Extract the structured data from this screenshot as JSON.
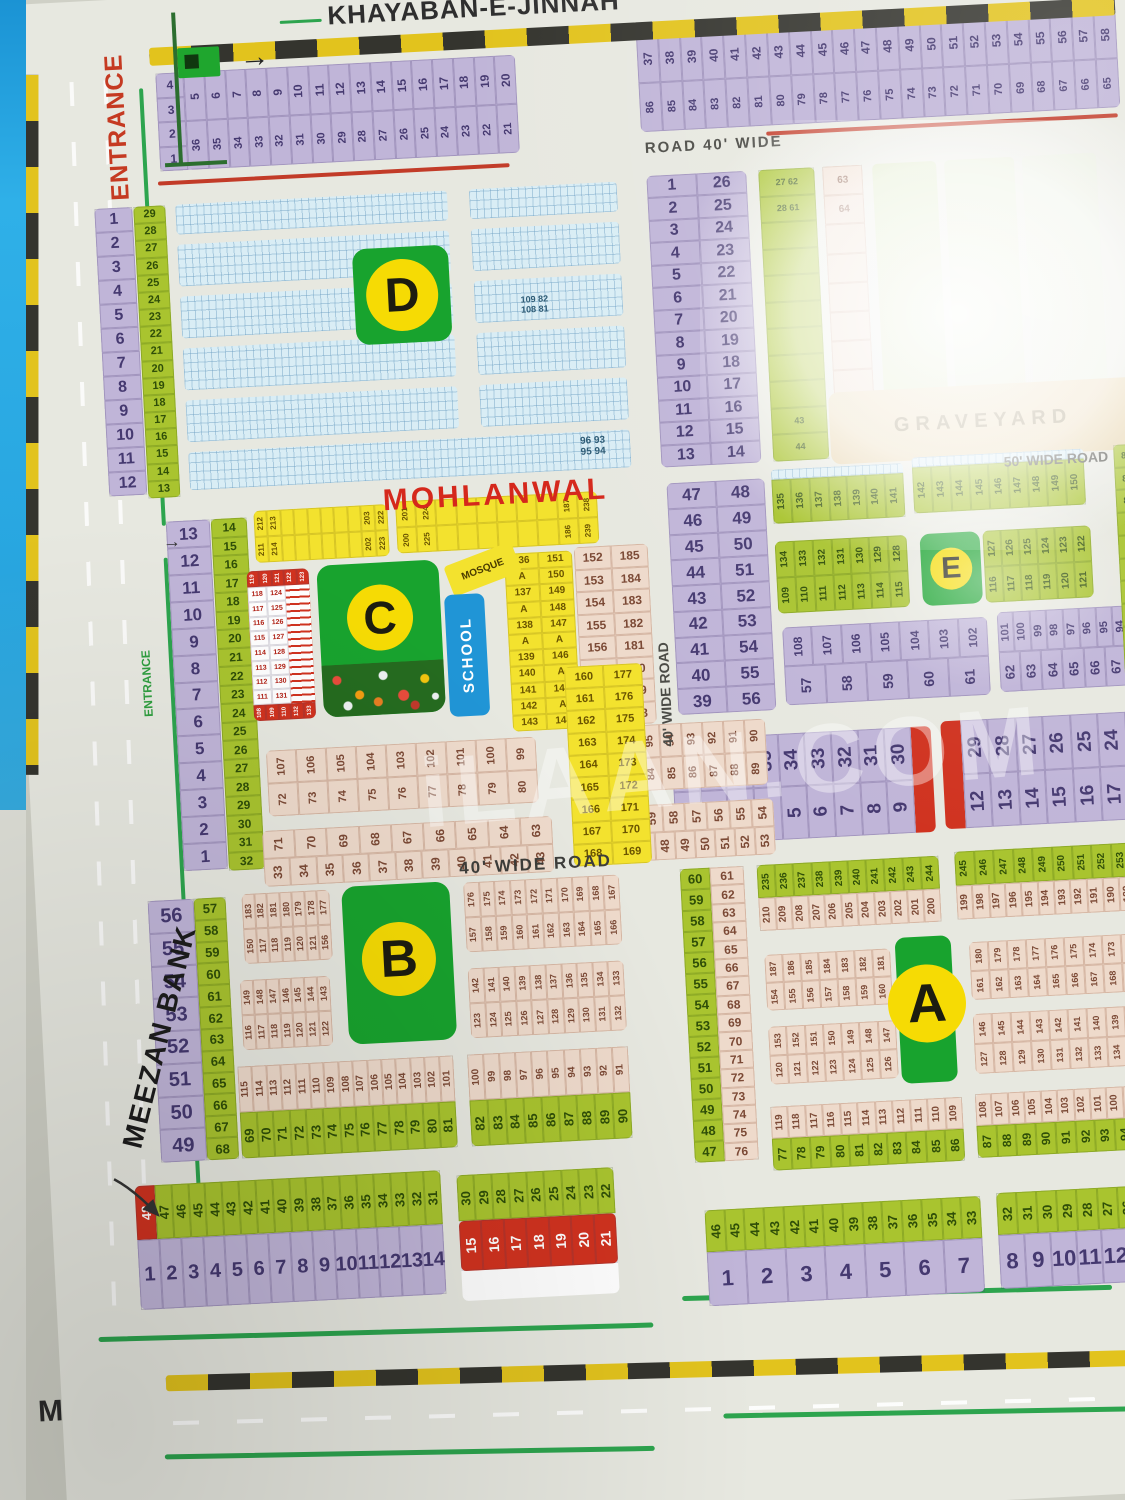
{
  "labels": {
    "road_top": "KHAYABAN-E-JINNAH",
    "entrance_main": "ENTRANCE",
    "entrance_small": "ENTRANCE",
    "road_corner": "ROAD",
    "road_40_wide": "ROAD 40' WIDE",
    "wide_50": "50' WIDE ROAD",
    "wide_40_v": "40' WIDE ROAD",
    "wide_40_h": "40' WIDE ROAD",
    "town": "MOHLANWAL",
    "bank": "MEEZAN BANK",
    "graveyard": "GRAVEYARD",
    "mosque": "MOSQUE",
    "school": "SCHOOL",
    "m": "M",
    "arrow": "→",
    "watermark": "iLAAN.COM"
  },
  "badges": {
    "a": "A",
    "b": "B",
    "c": "C",
    "d": "D",
    "e": "E"
  },
  "top_left_strip": {
    "left_col": [
      "4",
      "3",
      "2",
      "1"
    ],
    "row_top": [
      "5",
      "6",
      "7",
      "8",
      "9",
      "10",
      "11",
      "12",
      "13",
      "14",
      "15",
      "16",
      "17",
      "18",
      "19",
      "20"
    ],
    "row_bottom": [
      "36",
      "35",
      "34",
      "33",
      "32",
      "31",
      "30",
      "29",
      "28",
      "27",
      "26",
      "25",
      "24",
      "23",
      "22",
      "21"
    ]
  },
  "top_right_strip": {
    "row_top": [
      "37",
      "38",
      "39",
      "40",
      "41",
      "42",
      "43",
      "44",
      "45",
      "46",
      "47",
      "48",
      "49",
      "50",
      "51",
      "52",
      "53",
      "54",
      "55",
      "56",
      "57",
      "58"
    ],
    "row_bottom": [
      "86",
      "85",
      "84",
      "83",
      "82",
      "81",
      "80",
      "79",
      "78",
      "77",
      "76",
      "75",
      "74",
      "73",
      "72",
      "71",
      "70",
      "69",
      "68",
      "67",
      "66",
      "65"
    ]
  },
  "d_section": {
    "purple_col": [
      "1",
      "2",
      "3",
      "4",
      "5",
      "6",
      "7",
      "8",
      "9",
      "10",
      "11",
      "12"
    ],
    "green_col": [
      "29",
      "28",
      "27",
      "26",
      "25",
      "24",
      "23",
      "22",
      "21",
      "20",
      "19",
      "18",
      "17",
      "16",
      "15",
      "14",
      "13"
    ],
    "table": [
      [
        "1",
        "26"
      ],
      [
        "2",
        "25"
      ],
      [
        "3",
        "24"
      ],
      [
        "4",
        "23"
      ],
      [
        "5",
        "22"
      ],
      [
        "6",
        "21"
      ],
      [
        "7",
        "20"
      ],
      [
        "8",
        "19"
      ],
      [
        "9",
        "18"
      ],
      [
        "10",
        "17"
      ],
      [
        "11",
        "16"
      ],
      [
        "12",
        "15"
      ],
      [
        "13",
        "14"
      ]
    ],
    "green_strip": [
      "27 62",
      "28 61",
      "",
      "",
      "",
      "",
      "",
      "",
      "",
      "43",
      "44"
    ],
    "pink_strip": [
      "63",
      "64",
      "",
      "",
      "",
      "",
      "",
      "",
      "",
      ""
    ],
    "ann_mid_top": "109 82",
    "ann_mid_bottom": "108 81",
    "ann_br_top": "96 93",
    "ann_br_bottom": "95 94"
  },
  "c_section": {
    "purple_col": [
      "13",
      "12",
      "11",
      "10",
      "9",
      "8",
      "7",
      "6",
      "5",
      "4",
      "3",
      "2",
      "1"
    ],
    "green_col": [
      "14",
      "15",
      "16",
      "17",
      "18",
      "19",
      "20",
      "21",
      "22",
      "23",
      "24",
      "25",
      "26",
      "27",
      "28",
      "29",
      "30",
      "31",
      "32"
    ],
    "yellow1_top": [
      "212",
      "213",
      "",
      "",
      "",
      "",
      "",
      "",
      "203",
      "222"
    ],
    "yellow1_bottom": [
      "211",
      "214",
      "",
      "",
      "",
      "",
      "",
      "",
      "202",
      "223"
    ],
    "yellow2_top": [
      "201",
      "224",
      "",
      "",
      "",
      "",
      "",
      "",
      "187",
      "238"
    ],
    "yellow2_bottom": [
      "200",
      "225",
      "",
      "",
      "",
      "",
      "",
      "",
      "186",
      "239"
    ],
    "red_block": {
      "top": [
        "119",
        "120",
        "121",
        "122",
        "123"
      ],
      "pairs": [
        [
          "118",
          "124"
        ],
        [
          "117",
          "125"
        ],
        [
          "116",
          "126"
        ],
        [
          "115",
          "127"
        ],
        [
          "114",
          "128"
        ],
        [
          "113",
          "129"
        ],
        [
          "112",
          "130"
        ],
        [
          "111",
          "131"
        ]
      ],
      "bottom": [
        "108",
        "109",
        "110",
        "132",
        "133"
      ]
    },
    "yellow_pairs": [
      [
        "136",
        "151"
      ],
      [
        "A",
        "150"
      ],
      [
        "137",
        "149"
      ],
      [
        "A",
        "148"
      ],
      [
        "138",
        "147"
      ],
      [
        "A",
        "A"
      ],
      [
        "139",
        "146"
      ],
      [
        "140",
        "A"
      ],
      [
        "141",
        "145"
      ],
      [
        "142",
        "A"
      ],
      [
        "143",
        "144"
      ]
    ],
    "pink_pairs": [
      [
        "152",
        "185"
      ],
      [
        "153",
        "184"
      ],
      [
        "154",
        "183"
      ],
      [
        "155",
        "182"
      ],
      [
        "156",
        "181"
      ],
      [
        "157",
        "180"
      ],
      [
        "158",
        "179"
      ],
      [
        "159",
        "178"
      ]
    ]
  },
  "c_lower": {
    "left_r1": [
      "107",
      "106",
      "105",
      "104",
      "103",
      "102",
      "101",
      "100",
      "99"
    ],
    "left_r2": [
      "72",
      "73",
      "74",
      "75",
      "76",
      "77",
      "78",
      "79",
      "80"
    ],
    "left_r3": [
      "71",
      "70",
      "69",
      "68",
      "67",
      "66",
      "65",
      "64",
      "63"
    ],
    "left_r4": [
      "33",
      "34",
      "35",
      "36",
      "37",
      "38",
      "39",
      "40",
      "41",
      "42",
      "43"
    ],
    "right_r1": [
      "98",
      "97",
      "96",
      "95",
      "94",
      "93",
      "92",
      "91",
      "90"
    ],
    "right_r2": [
      "81",
      "82",
      "83",
      "84",
      "85",
      "86",
      "87",
      "88",
      "89"
    ],
    "right_r3": [
      "62",
      "61",
      "60",
      "59",
      "58",
      "57",
      "56",
      "55",
      "54"
    ],
    "right_r4": [
      "44",
      "45",
      "46",
      "47",
      "48",
      "49",
      "50",
      "51",
      "52",
      "53"
    ],
    "yellow_pairs": [
      [
        "160",
        "177"
      ],
      [
        "161",
        "176"
      ],
      [
        "162",
        "175"
      ],
      [
        "163",
        "174"
      ],
      [
        "164",
        "173"
      ],
      [
        "165",
        "172"
      ],
      [
        "166",
        "171"
      ],
      [
        "167",
        "170"
      ],
      [
        "168",
        "169"
      ]
    ]
  },
  "e_section": {
    "table": [
      [
        "47",
        "48"
      ],
      [
        "46",
        "49"
      ],
      [
        "45",
        "50"
      ],
      [
        "44",
        "51"
      ],
      [
        "43",
        "52"
      ],
      [
        "42",
        "53"
      ],
      [
        "41",
        "54"
      ],
      [
        "40",
        "55"
      ],
      [
        "39",
        "56"
      ]
    ],
    "strip1": [
      "135",
      "136",
      "137",
      "138",
      "139",
      "140",
      "141"
    ],
    "strip2": [
      "142",
      "143",
      "144",
      "145",
      "146",
      "147",
      "148",
      "149",
      "150"
    ],
    "block_left_top": [
      "134",
      "133",
      "132",
      "131",
      "130",
      "129",
      "128"
    ],
    "block_left_bottom": [
      "109",
      "110",
      "111",
      "112",
      "113",
      "114",
      "115"
    ],
    "block_right_top": [
      "127",
      "126",
      "125",
      "124",
      "123",
      "122"
    ],
    "block_right_bottom": [
      "116",
      "117",
      "118",
      "119",
      "120",
      "121"
    ],
    "purple_left_top": [
      "108",
      "107",
      "106",
      "105",
      "104",
      "103",
      "102"
    ],
    "purple_left_bottom": [
      "57",
      "58",
      "59",
      "60",
      "61"
    ],
    "purple_right_top": [
      "101",
      "100",
      "99",
      "98",
      "97",
      "96",
      "95",
      "94",
      "93"
    ],
    "purple_right_bottom": [
      "62",
      "63",
      "64",
      "65",
      "66",
      "67",
      "68"
    ],
    "right_col": [
      "82",
      "83",
      "84",
      "85",
      "86",
      "87",
      "88",
      "89",
      "90",
      "91",
      "92"
    ]
  },
  "mid_strips": {
    "s1_top": [
      "38",
      "37",
      "36",
      "35",
      "34",
      "33",
      "32",
      "31",
      "30"
    ],
    "s1_bottom": [
      "1",
      "2",
      "3",
      "4",
      "5",
      "6",
      "7",
      "8",
      "9"
    ],
    "s2_top": [
      "29",
      "28",
      "27",
      "26",
      "25",
      "24",
      "23"
    ],
    "s2_bottom": [
      "12",
      "13",
      "14",
      "15",
      "16",
      "17",
      "18"
    ]
  },
  "b_section": {
    "purple_col": [
      "56",
      "55",
      "54",
      "53",
      "52",
      "51",
      "50",
      "49"
    ],
    "green_col": [
      "57",
      "58",
      "59",
      "60",
      "61",
      "62",
      "63",
      "64",
      "65",
      "66",
      "67",
      "68"
    ],
    "tl_top": [
      "183",
      "182",
      "181",
      "180",
      "179",
      "178",
      "177"
    ],
    "tl_bottom": [
      "150",
      "117",
      "118",
      "119",
      "120",
      "121",
      "156"
    ],
    "ml_top": [
      "149",
      "148",
      "147",
      "146",
      "145",
      "144",
      "143"
    ],
    "ml_bottom": [
      "116",
      "117",
      "118",
      "119",
      "120",
      "121",
      "122"
    ],
    "tr_top": [
      "176",
      "175",
      "174",
      "173",
      "172",
      "171",
      "170",
      "169",
      "168",
      "167"
    ],
    "tr_bottom": [
      "157",
      "158",
      "159",
      "160",
      "161",
      "162",
      "163",
      "164",
      "165",
      "166"
    ],
    "mr_top": [
      "142",
      "141",
      "140",
      "139",
      "138",
      "137",
      "136",
      "135",
      "134",
      "133"
    ],
    "mr_bottom": [
      "123",
      "124",
      "125",
      "126",
      "127",
      "128",
      "129",
      "130",
      "131",
      "132"
    ],
    "bl_pink": [
      "115",
      "114",
      "113",
      "112",
      "111",
      "110",
      "109",
      "108",
      "107",
      "106",
      "105",
      "104",
      "103",
      "102",
      "101"
    ],
    "bl_green": [
      "69",
      "70",
      "71",
      "72",
      "73",
      "74",
      "75",
      "76",
      "77",
      "78",
      "79",
      "80",
      "81"
    ],
    "br_pink": [
      "100",
      "99",
      "98",
      "97",
      "96",
      "95",
      "94",
      "93",
      "92",
      "91"
    ],
    "br_green": [
      "82",
      "83",
      "84",
      "85",
      "86",
      "87",
      "88",
      "89",
      "90"
    ]
  },
  "a_section": {
    "green_col": [
      "60",
      "59",
      "58",
      "57",
      "56",
      "55",
      "54",
      "53",
      "52",
      "51",
      "50",
      "49",
      "48",
      "47"
    ],
    "tan_col": [
      "61",
      "62",
      "63",
      "64",
      "65",
      "66",
      "67",
      "68",
      "69",
      "70",
      "71",
      "72",
      "73",
      "74",
      "75",
      "76"
    ],
    "tl_green": [
      "235",
      "236",
      "237",
      "238",
      "239",
      "240",
      "241",
      "242",
      "243",
      "244"
    ],
    "tl_pink": [
      "210",
      "209",
      "208",
      "207",
      "206",
      "205",
      "204",
      "203",
      "202",
      "201",
      "200"
    ],
    "tr_green": [
      "245",
      "246",
      "247",
      "248",
      "249",
      "250",
      "251",
      "252",
      "253",
      "254"
    ],
    "tr_pink": [
      "199",
      "198",
      "197",
      "196",
      "195",
      "194",
      "193",
      "192",
      "191",
      "190",
      "189",
      "188"
    ],
    "b1l_top": [
      "187",
      "186",
      "185",
      "184",
      "183",
      "182",
      "181"
    ],
    "b1l_bottom": [
      "154",
      "155",
      "156",
      "157",
      "158",
      "159",
      "160"
    ],
    "b1r_top": [
      "180",
      "179",
      "178",
      "177",
      "176",
      "175",
      "174",
      "173",
      "172",
      "171"
    ],
    "b1r_bottom": [
      "161",
      "162",
      "163",
      "164",
      "165",
      "166",
      "167",
      "168",
      "169",
      "170"
    ],
    "b2l_top": [
      "153",
      "152",
      "151",
      "150",
      "149",
      "148",
      "147"
    ],
    "b2l_bottom": [
      "120",
      "121",
      "122",
      "123",
      "124",
      "125",
      "126"
    ],
    "b2r_top": [
      "146",
      "145",
      "144",
      "143",
      "142",
      "141",
      "140",
      "139",
      "138",
      "137"
    ],
    "b2r_bottom": [
      "127",
      "128",
      "129",
      "130",
      "131",
      "132",
      "133",
      "134",
      "135",
      "136"
    ],
    "bl_pink": [
      "119",
      "118",
      "117",
      "116",
      "115",
      "114",
      "113",
      "112",
      "111",
      "110",
      "109"
    ],
    "bl_green": [
      "77",
      "78",
      "79",
      "80",
      "81",
      "82",
      "83",
      "84",
      "85",
      "86"
    ],
    "br_pink": [
      "108",
      "107",
      "106",
      "105",
      "104",
      "103",
      "102",
      "101",
      "100",
      "99",
      "98",
      "97"
    ],
    "br_green": [
      "87",
      "88",
      "89",
      "90",
      "91",
      "92",
      "93",
      "94",
      "95",
      "96"
    ]
  },
  "bottom_rows": {
    "b1_first": "48",
    "b1_green": [
      "47",
      "46",
      "45",
      "44",
      "43",
      "42",
      "41",
      "40",
      "39",
      "38",
      "37",
      "36",
      "35",
      "34",
      "33",
      "32",
      "31"
    ],
    "b1_purple": [
      "1",
      "2",
      "3",
      "4",
      "5",
      "6",
      "7",
      "8",
      "9",
      "10",
      "11",
      "12",
      "13",
      "14"
    ],
    "b2_green": [
      "30",
      "29",
      "28",
      "27",
      "26",
      "25",
      "24",
      "23",
      "22"
    ],
    "b2_red": [
      "15",
      "16",
      "17",
      "18",
      "19",
      "20",
      "21"
    ],
    "b3_green": [
      "46",
      "45",
      "44",
      "43",
      "42",
      "41",
      "40",
      "39",
      "38",
      "37",
      "36",
      "35",
      "34",
      "33"
    ],
    "b3_purple": [
      "1",
      "2",
      "3",
      "4",
      "5",
      "6",
      "7"
    ],
    "b4_green": [
      "32",
      "31",
      "30",
      "29",
      "28",
      "27",
      "26",
      "25",
      "24"
    ],
    "b4_purple": [
      "8",
      "9",
      "10",
      "11",
      "12",
      "13",
      "14"
    ]
  }
}
